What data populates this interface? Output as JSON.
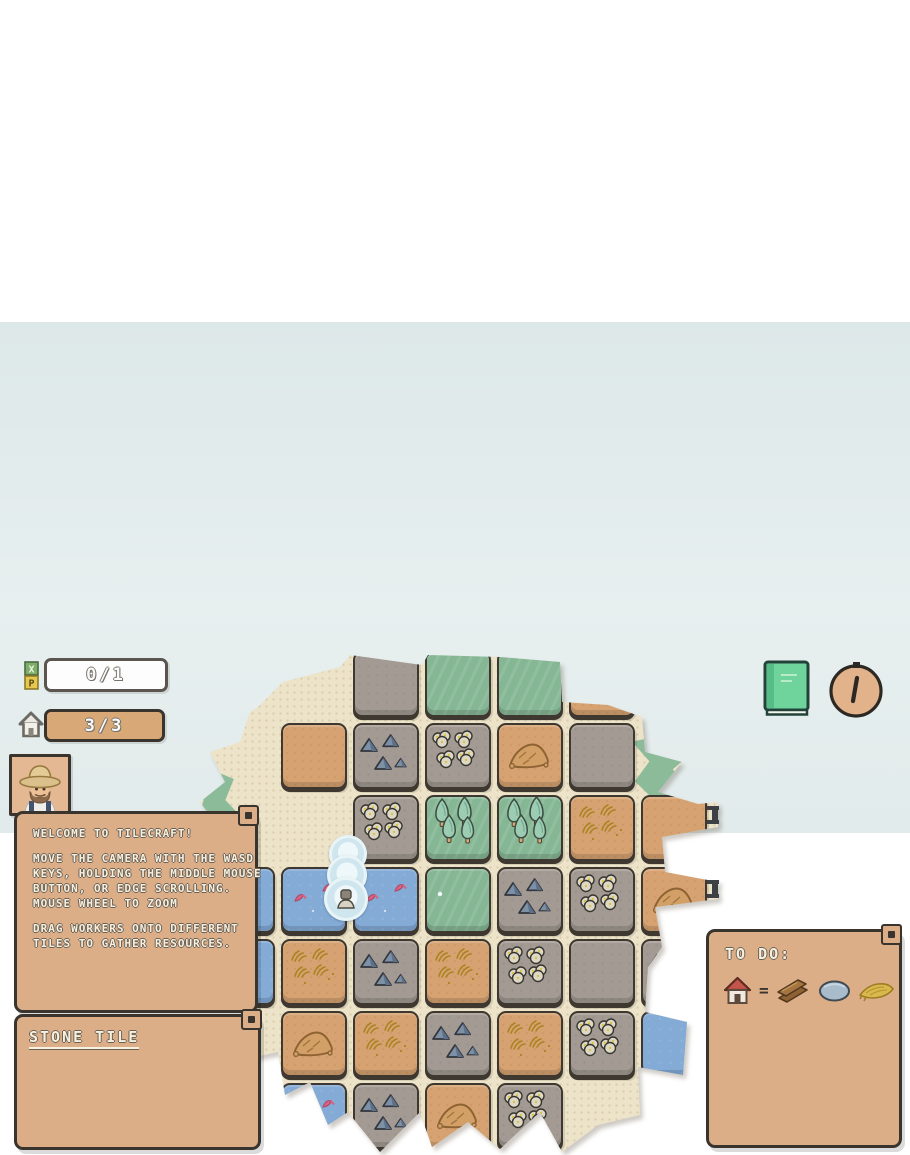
{
  "hud": {
    "xp_counter": "0/1",
    "xp_letters": [
      "X",
      "P"
    ],
    "house_counter": "3/3"
  },
  "topright": {
    "book_icon": "green-book",
    "clock_icon": "pocket-watch"
  },
  "welcome_dialog": {
    "lines": [
      "WELCOME TO TILECRAFT!",
      "",
      "MOVE THE CAMERA WITH THE WASD",
      "KEYS, HOLDING THE MIDDLE MOUSE",
      "BUTTON, OR EDGE SCROLLING.",
      "MOUSE WHEEL TO ZOOM",
      "",
      "DRAG WORKERS ONTO DIFFERENT",
      "TILES TO GATHER RESOURCES."
    ]
  },
  "tile_panel": {
    "title": "STONE TILE"
  },
  "todo_panel": {
    "title": "TO DO:",
    "equals": "=",
    "goal_icon": "red-roof-house",
    "cost_icons": [
      "wood-planks",
      "stone-boulder",
      "wheat-sheaf"
    ]
  },
  "map": {
    "worker_stack_count": 3,
    "tile_legend": {
      "sand": "empty sand tile",
      "sand_wheat": "sand tile with wheat",
      "sand_mound": "sand tile with dirt mound",
      "stone": "empty stone tile",
      "stone_dark": "stone tile with blue rocks",
      "stone_light": "stone tile with pale boulders",
      "grass": "empty grass tile",
      "grass_sparkle": "grass tile with sparkle",
      "grass_trees": "grass tile with trees",
      "water": "water tile",
      "water_fish": "water tile with fish"
    },
    "tiles": [
      {
        "r": 1,
        "c": 2,
        "t": "stone"
      },
      {
        "r": 1,
        "c": 3,
        "t": "grass"
      },
      {
        "r": 1,
        "c": 4,
        "t": "grass"
      },
      {
        "r": 1,
        "c": 5,
        "t": "sand"
      },
      {
        "r": 2,
        "c": 1,
        "t": "sand"
      },
      {
        "r": 2,
        "c": 2,
        "t": "stone_dark"
      },
      {
        "r": 2,
        "c": 3,
        "t": "stone_light"
      },
      {
        "r": 2,
        "c": 4,
        "t": "sand_mound"
      },
      {
        "r": 2,
        "c": 5,
        "t": "stone"
      },
      {
        "r": 3,
        "c": 2,
        "t": "stone_light"
      },
      {
        "r": 3,
        "c": 3,
        "t": "grass_trees"
      },
      {
        "r": 3,
        "c": 4,
        "t": "grass_trees"
      },
      {
        "r": 3,
        "c": 5,
        "t": "sand_wheat"
      },
      {
        "r": 3,
        "c": 6,
        "t": "sand"
      },
      {
        "r": 4,
        "c": 0,
        "t": "water"
      },
      {
        "r": 4,
        "c": 1,
        "t": "water_fish"
      },
      {
        "r": 4,
        "c": 2,
        "t": "water_fish"
      },
      {
        "r": 4,
        "c": 3,
        "t": "grass_sparkle"
      },
      {
        "r": 4,
        "c": 4,
        "t": "stone_dark"
      },
      {
        "r": 4,
        "c": 5,
        "t": "stone_light"
      },
      {
        "r": 4,
        "c": 6,
        "t": "sand_mound"
      },
      {
        "r": 5,
        "c": 0,
        "t": "water"
      },
      {
        "r": 5,
        "c": 1,
        "t": "sand_wheat"
      },
      {
        "r": 5,
        "c": 2,
        "t": "stone_dark"
      },
      {
        "r": 5,
        "c": 3,
        "t": "sand_wheat"
      },
      {
        "r": 5,
        "c": 4,
        "t": "stone_light"
      },
      {
        "r": 5,
        "c": 5,
        "t": "stone"
      },
      {
        "r": 5,
        "c": 6,
        "t": "stone_dark"
      },
      {
        "r": 6,
        "c": 1,
        "t": "sand_mound"
      },
      {
        "r": 6,
        "c": 2,
        "t": "sand_wheat"
      },
      {
        "r": 6,
        "c": 3,
        "t": "stone_dark"
      },
      {
        "r": 6,
        "c": 4,
        "t": "sand_wheat"
      },
      {
        "r": 6,
        "c": 5,
        "t": "stone_light"
      },
      {
        "r": 6,
        "c": 6,
        "t": "water"
      },
      {
        "r": 7,
        "c": 1,
        "t": "water_fish"
      },
      {
        "r": 7,
        "c": 2,
        "t": "stone_dark"
      },
      {
        "r": 7,
        "c": 3,
        "t": "sand_mound"
      },
      {
        "r": 7,
        "c": 4,
        "t": "stone_light"
      }
    ]
  },
  "colors": {
    "background": "#e2ebeb",
    "parchment": "#ece3c8",
    "panel": "#dcae87",
    "sand_tile": "#d7a271",
    "stone_tile": "#a39b93",
    "grass_tile": "#86b795",
    "water_tile": "#84abd6",
    "book_green": "#6fd49c",
    "roof_red": "#c5554a"
  }
}
